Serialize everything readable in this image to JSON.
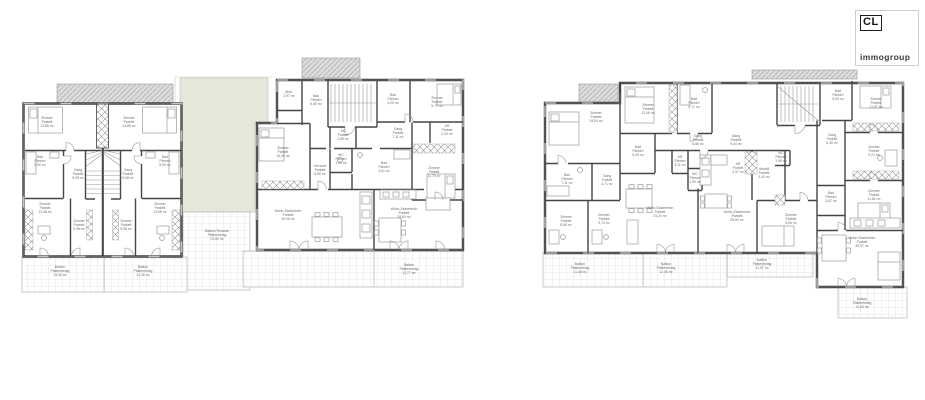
{
  "logo": {
    "initials": "CL",
    "name": "immogroup"
  },
  "plans": [
    {
      "name": "left-floorplan",
      "labels": [
        {
          "t": "Zimmer\nParkett\n14,88 m²",
          "x": 47,
          "y": 123
        },
        {
          "t": "Zimmer\nParkett\n14,88 m²",
          "x": 129,
          "y": 123
        },
        {
          "t": "Bad\nFliesen\n5,90 m²",
          "x": 40,
          "y": 162
        },
        {
          "t": "Bad\nFliesen\n5,90 m²",
          "x": 165,
          "y": 162
        },
        {
          "t": "Gang\nParkett\n5,08 m²",
          "x": 78,
          "y": 175
        },
        {
          "t": "Gang\nParkett\n5,08 m²",
          "x": 128,
          "y": 175
        },
        {
          "t": "Zimmer\nParkett\n13,08 m²",
          "x": 45,
          "y": 209
        },
        {
          "t": "Zimmer\nParkett\n13,08 m²",
          "x": 160,
          "y": 209
        },
        {
          "t": "Zimmer\nParkett\n9,98 m²",
          "x": 79,
          "y": 226
        },
        {
          "t": "Zimmer\nParkett\n9,98 m²",
          "x": 126,
          "y": 226
        },
        {
          "t": "Balkon\nPlattenbelag\n13,36 m²",
          "x": 60,
          "y": 272
        },
        {
          "t": "Balkon\nPlattenbelag\n13,36 m²",
          "x": 143,
          "y": 272
        },
        {
          "t": "Abst.\n2,97 m²",
          "x": 289,
          "y": 95
        },
        {
          "t": "Bad\nFliesen\n5,60 m²",
          "x": 316,
          "y": 101
        },
        {
          "t": "Bad\nFliesen\n4,20 m²",
          "x": 393,
          "y": 100
        },
        {
          "t": "Zimmer\nParkett\n9,72 m²",
          "x": 437,
          "y": 103
        },
        {
          "t": "Zimmer\nParkett\n15,06 m²",
          "x": 283,
          "y": 153
        },
        {
          "t": "AR\nParkett\n2,85 m²",
          "x": 343,
          "y": 136
        },
        {
          "t": "Gang\nParkett\n7,11 m²",
          "x": 398,
          "y": 134
        },
        {
          "t": "AR\nParkett\n2,00 m²",
          "x": 447,
          "y": 131
        },
        {
          "t": "Vorraum\nParkett\n8,85 m²",
          "x": 320,
          "y": 171
        },
        {
          "t": "WC\nFliesen\n1,90 m²",
          "x": 341,
          "y": 160
        },
        {
          "t": "Bad\nFliesen\n4,51 m²",
          "x": 384,
          "y": 168
        },
        {
          "t": "Zimmer\nParkett\n11,75 m²",
          "x": 434,
          "y": 173
        },
        {
          "t": "Wohn-Essbereich\nParkett\n30,05 m²",
          "x": 288,
          "y": 216
        },
        {
          "t": "Wohn-Essbereich\nParkett\n28,80 m²",
          "x": 404,
          "y": 214
        },
        {
          "t": "Balkon\nPlattenbelag\n12,77 m²",
          "x": 409,
          "y": 270
        },
        {
          "t": "Balkon/Terrasse\nPlattenbelag\n23,80 m²",
          "x": 217,
          "y": 236
        }
      ]
    },
    {
      "name": "right-floorplan",
      "labels": [
        {
          "t": "Zimmer\nParkett\n15,94 m²",
          "x": 596,
          "y": 118
        },
        {
          "t": "Zimmer\nParkett\n12,06 m²",
          "x": 648,
          "y": 110
        },
        {
          "t": "Bad\nFliesen\n5,17 m²",
          "x": 694,
          "y": 104
        },
        {
          "t": "Gang\nParkett\n6,88 m²",
          "x": 698,
          "y": 141
        },
        {
          "t": "Bad\nFliesen\n5,49 m²",
          "x": 638,
          "y": 152
        },
        {
          "t": "AR\nFliesen\n3,11 m²",
          "x": 680,
          "y": 162
        },
        {
          "t": "WC\nFliesen\n1,90 m²",
          "x": 695,
          "y": 179
        },
        {
          "t": "AR\nParkett\n2,97 m²",
          "x": 738,
          "y": 169
        },
        {
          "t": "Gang\nParkett\n9,44 m²",
          "x": 736,
          "y": 141
        },
        {
          "t": "Abstell\nParkett\n3,40 m²",
          "x": 764,
          "y": 174
        },
        {
          "t": "WC\nFliesen\n1,98 m²",
          "x": 781,
          "y": 158
        },
        {
          "t": "Bad\nFliesen\n5,05 m²",
          "x": 838,
          "y": 96
        },
        {
          "t": "Zimmer\nParkett\n11,57 m²",
          "x": 876,
          "y": 104
        },
        {
          "t": "Gang\nParkett\n6,30 m²",
          "x": 832,
          "y": 140
        },
        {
          "t": "Zimmer\nParkett\n9,21 m²",
          "x": 874,
          "y": 152
        },
        {
          "t": "Zimmer\nParkett\n11,81 m²",
          "x": 874,
          "y": 196
        },
        {
          "t": "Wohn-Essbereich\nParkett\n30,97 m²",
          "x": 862,
          "y": 243
        },
        {
          "t": "Bad\nFliesen\n7,11 m²",
          "x": 567,
          "y": 180
        },
        {
          "t": "Gang\nParkett\n4,71 m²",
          "x": 607,
          "y": 181
        },
        {
          "t": "Zimmer\nParkett\n8,86 m²",
          "x": 566,
          "y": 222
        },
        {
          "t": "Zimmer\nParkett\n9,74 m²",
          "x": 604,
          "y": 220
        },
        {
          "t": "Wohn-Essbereich\nParkett\n24,24 m²",
          "x": 660,
          "y": 213
        },
        {
          "t": "Wohn-Essbereich\nParkett\n26,53 m²",
          "x": 737,
          "y": 217
        },
        {
          "t": "Zimmer\nParkett\n9,06 m²",
          "x": 791,
          "y": 220
        },
        {
          "t": "Bad\nFliesen\n3,87 m²",
          "x": 831,
          "y": 198
        },
        {
          "t": "Balkon\nPlattenbelag\n11,48 m²",
          "x": 580,
          "y": 269
        },
        {
          "t": "Balkon\nPlattenbelag\n12,45 m²",
          "x": 666,
          "y": 269
        },
        {
          "t": "Balkon\nPlattenbelag\n12,07 m²",
          "x": 762,
          "y": 265
        },
        {
          "t": "Balkon\nPlattenbelag\n12,83 m²",
          "x": 862,
          "y": 304
        }
      ]
    }
  ]
}
